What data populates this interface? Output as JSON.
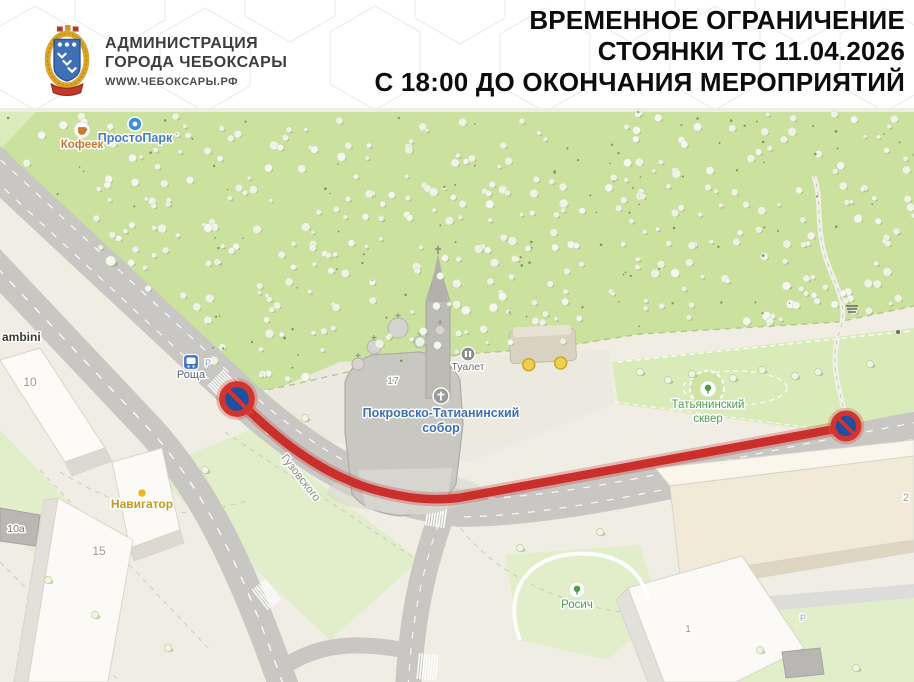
{
  "header": {
    "org_name_line1": "АДМИНИСТРАЦИЯ",
    "org_name_line2": "ГОРОДА ЧЕБОКСАРЫ",
    "org_site": "WWW.ЧЕБОКСАРЫ.РФ",
    "title_line1": "ВРЕМЕННОЕ ОГРАНИЧЕНИЕ",
    "title_line2": "СТОЯНКИ ТС 11.04.2026",
    "title_line3": "С 18:00 ДО ОКОНЧАНИЯ МЕРОПРИЯТИЙ"
  },
  "colors": {
    "map_bg": "#f0ede5",
    "park_green": "#cbe19e",
    "lawn_green": "#dfeec2",
    "road_gray": "#c8c7c4",
    "restriction_red": "#cb2f2c",
    "sign_blue": "#1f4f9e",
    "sign_ring_red": "#d23430",
    "building_white": "#fbfaf6",
    "building_beige": "#f1ead9",
    "cathedral_gray": "#c9c7c1"
  },
  "map": {
    "signs": [
      {
        "name": "no-parking-sign-left",
        "x": 237,
        "y": 399,
        "r": 16
      },
      {
        "name": "no-parking-sign-right",
        "x": 846,
        "y": 426,
        "r": 14
      }
    ],
    "labels": [
      {
        "name": "poi-gambini",
        "text": "ambini",
        "x": 2,
        "y": 341,
        "fill": "#3a3a38",
        "size": 12,
        "bold": true,
        "anchor": "start"
      },
      {
        "name": "poi-prostopark",
        "text": "ПростоПарк",
        "x": 135,
        "y": 142,
        "fill": "#3f7ec6",
        "size": 12.5,
        "bold": true,
        "icon": {
          "type": "circle",
          "cx": 135,
          "cy": 124
        }
      },
      {
        "name": "poi-kofeek",
        "text": "Кофеек",
        "x": 82,
        "y": 148,
        "fill": "#c8792a",
        "size": 11.5,
        "bold": true,
        "icon": {
          "type": "cup",
          "cx": 82,
          "cy": 130
        }
      },
      {
        "name": "transit-stop-roscha",
        "text": "Роща",
        "x": 191,
        "y": 378,
        "fill": "#55627a",
        "size": 11,
        "icon": {
          "type": "bus",
          "cx": 191,
          "cy": 362
        }
      },
      {
        "name": "parking-mark-roscha",
        "text": "Р",
        "x": 208,
        "y": 366,
        "fill": "#7f9cc9",
        "size": 9
      },
      {
        "name": "poi-sobor-line1",
        "text": "Покровско-Татианинский",
        "x": 441,
        "y": 417,
        "fill": "#3d6fb5",
        "size": 12.5,
        "bold": true,
        "icon": {
          "type": "cross",
          "cx": 441,
          "cy": 396
        }
      },
      {
        "name": "poi-sobor-line2",
        "text": "собор",
        "x": 441,
        "y": 432,
        "fill": "#3d6fb5",
        "size": 12.5,
        "bold": true
      },
      {
        "name": "poi-tualet",
        "text": "Туалет",
        "x": 468,
        "y": 370,
        "fill": "#6e6e6e",
        "size": 10.5,
        "icon": {
          "type": "wc",
          "cx": 468,
          "cy": 354
        }
      },
      {
        "name": "poi-skver-line1",
        "text": "Татьянинский",
        "x": 708,
        "y": 408,
        "fill": "#4f9d4f",
        "size": 11.5,
        "icon": {
          "type": "tree",
          "cx": 708,
          "cy": 389
        }
      },
      {
        "name": "poi-skver-line2",
        "text": "сквер",
        "x": 708,
        "y": 422,
        "fill": "#4f9d4f",
        "size": 11.5
      },
      {
        "name": "poi-navigator",
        "text": "Навигатор",
        "x": 142,
        "y": 508,
        "fill": "#c09a1a",
        "size": 12,
        "bold": true,
        "icon": {
          "type": "dot",
          "cx": 142,
          "cy": 493
        }
      },
      {
        "name": "poi-rosich",
        "text": "Росич",
        "x": 577,
        "y": 608,
        "fill": "#4f9d4f",
        "size": 11.5,
        "icon": {
          "type": "tree",
          "cx": 577,
          "cy": 590
        }
      },
      {
        "name": "street-guzovskogo",
        "text": "Гузовского",
        "x": 298,
        "y": 480,
        "fill": "#8a8880",
        "size": 11.5,
        "rotate": 52
      },
      {
        "name": "bldg-num-10",
        "text": "10",
        "x": 30,
        "y": 386,
        "fill": "#9c988e",
        "size": 12
      },
      {
        "name": "bldg-num-15",
        "text": "15",
        "x": 99,
        "y": 555,
        "fill": "#9c988e",
        "size": 12
      },
      {
        "name": "bldg-num-10a",
        "text": "10а",
        "x": 16,
        "y": 532,
        "fill": "#76746f",
        "size": 10.5
      },
      {
        "name": "bldg-num-17",
        "text": "17",
        "x": 393,
        "y": 384,
        "fill": "#8f8d86",
        "size": 10.5
      },
      {
        "name": "bldg-num-1",
        "text": "1",
        "x": 688,
        "y": 632,
        "fill": "#9c988e",
        "size": 10.5
      },
      {
        "name": "bldg-num-2",
        "text": "2",
        "x": 909,
        "y": 501,
        "fill": "#9c988e",
        "size": 11,
        "anchor": "end"
      },
      {
        "name": "parking-mark-strip",
        "text": "Р",
        "x": 803,
        "y": 621,
        "fill": "#8aa0c0",
        "size": 9
      }
    ]
  }
}
